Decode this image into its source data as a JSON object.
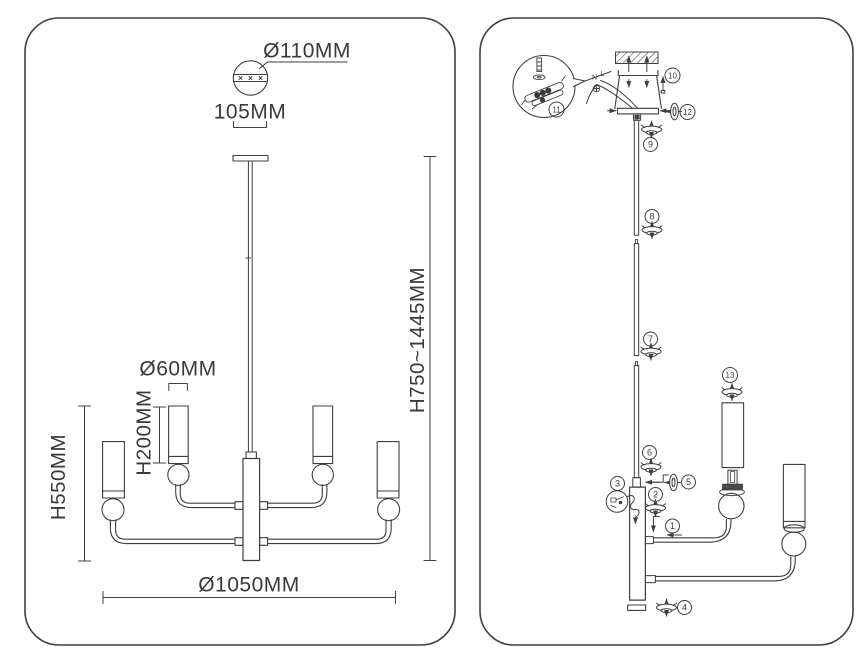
{
  "colors": {
    "line": "#3f3f3f",
    "text": "#3a3a3a",
    "bg": "#ffffff",
    "dark_fill": "#4a4a4a"
  },
  "left_panel": {
    "dims": {
      "canopy_diameter": "Ø110MM",
      "canopy_offset": "105MM",
      "total_height": "H750~1445MM",
      "shade_diameter": "Ø60MM",
      "shade_height": "H200MM",
      "body_height": "H550MM",
      "total_width": "Ø1050MM"
    }
  },
  "right_panel": {
    "wire_labels": {
      "neutral": "N",
      "live": "L"
    },
    "parts": [
      {
        "num": "1"
      },
      {
        "num": "2"
      },
      {
        "num": "3"
      },
      {
        "num": "4"
      },
      {
        "num": "5"
      },
      {
        "num": "6"
      },
      {
        "num": "7"
      },
      {
        "num": "8"
      },
      {
        "num": "9"
      },
      {
        "num": "10"
      },
      {
        "num": "11"
      },
      {
        "num": "12"
      },
      {
        "num": "13"
      }
    ]
  }
}
